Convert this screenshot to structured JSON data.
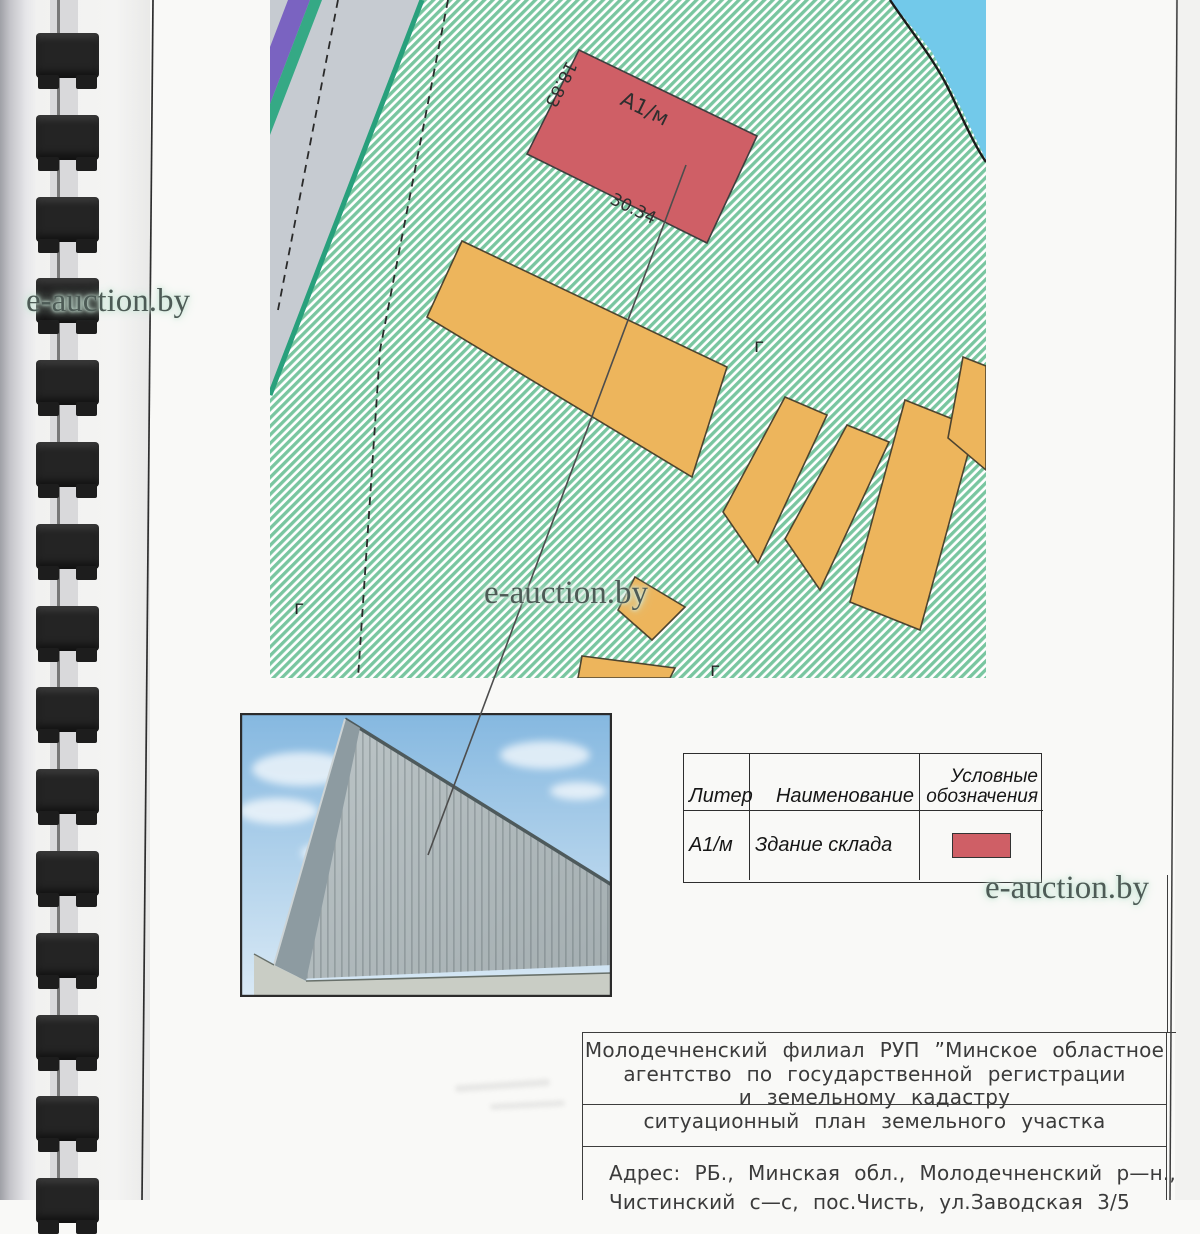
{
  "watermark": {
    "text": "e-auction.by"
  },
  "map": {
    "building_label": "А1/м",
    "dim_left": "18.83",
    "dim_bottom": "30.34",
    "tick": "г"
  },
  "legend": {
    "headers": [
      "Литер",
      "Наименование",
      "Условные обозначения"
    ],
    "row": {
      "liter": "А1/м",
      "name": "Здание склада",
      "symbol": "red-rectangle"
    }
  },
  "title_block": {
    "org_line1": "Молодечненский филиал РУП ”Минское областное",
    "org_line2": "агентство по государственной регистрации",
    "org_line3": "и земельному кадастру",
    "doc_type": "ситуационный план земельного участка",
    "address_line1": "Адрес: РБ., Минская обл., Молодечненский р—н.,",
    "address_line2": "Чистинский с—с, пос.Чисть, ул.Заводская 3/5"
  },
  "colors": {
    "paper": "#f9f9f7",
    "hatch_green": "#79c6a0",
    "road_gray": "#c6cbd1",
    "utility_purple": "#7a63c1",
    "boundary_teal": "#28a07c",
    "water_blue": "#72c9ea",
    "building_red": "#cf5f66",
    "building_orange": "#edb55c",
    "binding_black": "#242424"
  }
}
